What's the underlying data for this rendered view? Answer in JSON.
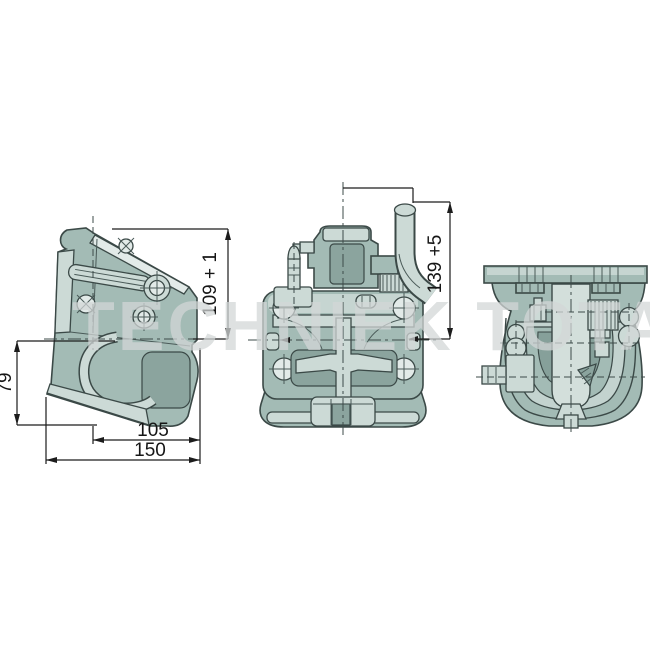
{
  "drawing": {
    "watermark": "TECHNIEK TOTAAL",
    "dimensions": {
      "upper_height": "109 + 1",
      "handle_height": "139 +5",
      "jaw_height": "79",
      "inner_width": "105",
      "overall_width": "150"
    },
    "colors": {
      "background": "#ffffff",
      "part_body": "#a3bbb5",
      "part_light": "#ccdad6",
      "part_dark": "#7a958f",
      "outline": "#3b4947",
      "dimension_lines": "#1c1c1c",
      "watermark_gray": "#d3d7d6"
    }
  }
}
